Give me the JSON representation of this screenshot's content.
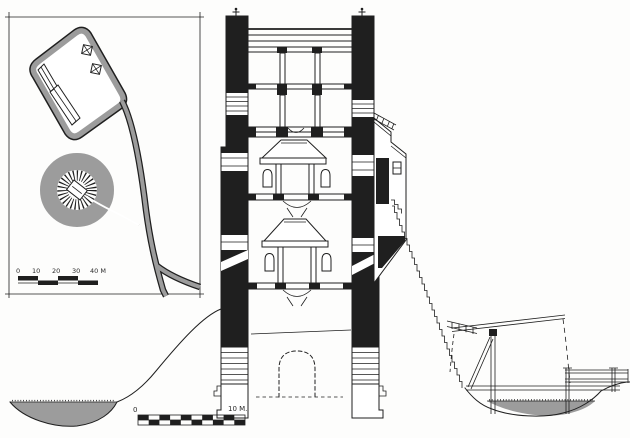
{
  "figure": {
    "kind": "hand-drawn architectural drawing",
    "subject": "motte-and-bailey castle: site plan inset and tower cross-section with moat and drawbridge"
  },
  "colors": {
    "ink": "#1f1f1f",
    "gray": "#9c9c9c",
    "paper": "#fdfdfc"
  },
  "inset_plan": {
    "scale_labels": [
      "0",
      "10",
      "20",
      "30",
      "40 M"
    ]
  },
  "main_scale": {
    "start": "0",
    "end": "10 M."
  }
}
